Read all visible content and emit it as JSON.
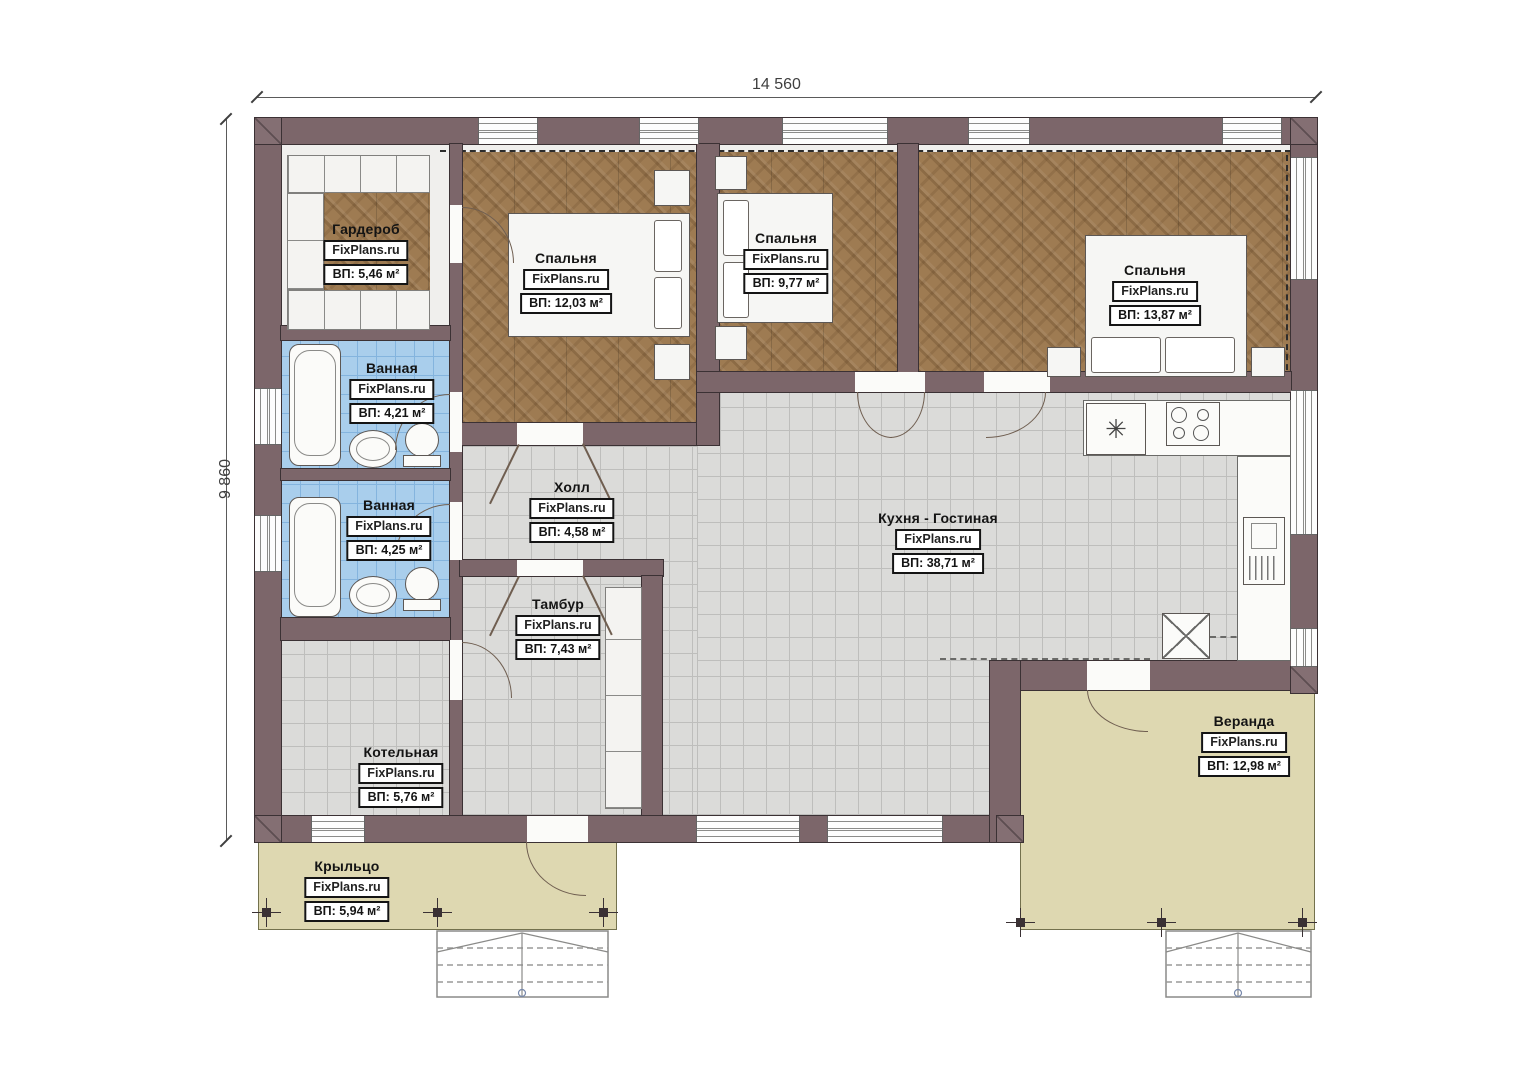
{
  "plan": {
    "brand": "FixPlans.ru",
    "dimensions": {
      "width": "14 560",
      "height": "9 860"
    },
    "icons": {
      "sink_glyph": "✳"
    },
    "rooms": [
      {
        "name": "Гардероб",
        "area": "ВП: 5,46 м²"
      },
      {
        "name": "Спальня",
        "area": "ВП: 12,03 м²"
      },
      {
        "name": "Спальня",
        "area": "ВП: 9,77 м²"
      },
      {
        "name": "Спальня",
        "area": "ВП: 13,87 м²"
      },
      {
        "name": "Ванная",
        "area": "ВП: 4,21 м²"
      },
      {
        "name": "Ванная",
        "area": "ВП: 4,25 м²"
      },
      {
        "name": "Холл",
        "area": "ВП: 4,58 м²"
      },
      {
        "name": "Кухня - Гостиная",
        "area": "ВП: 38,71 м²"
      },
      {
        "name": "Тамбур",
        "area": "ВП: 7,43 м²"
      },
      {
        "name": "Котельная",
        "area": "ВП: 5,76 м²"
      },
      {
        "name": "Веранда",
        "area": "ВП: 12,98 м²"
      },
      {
        "name": "Крыльцо",
        "area": "ВП: 5,94 м²"
      }
    ]
  }
}
